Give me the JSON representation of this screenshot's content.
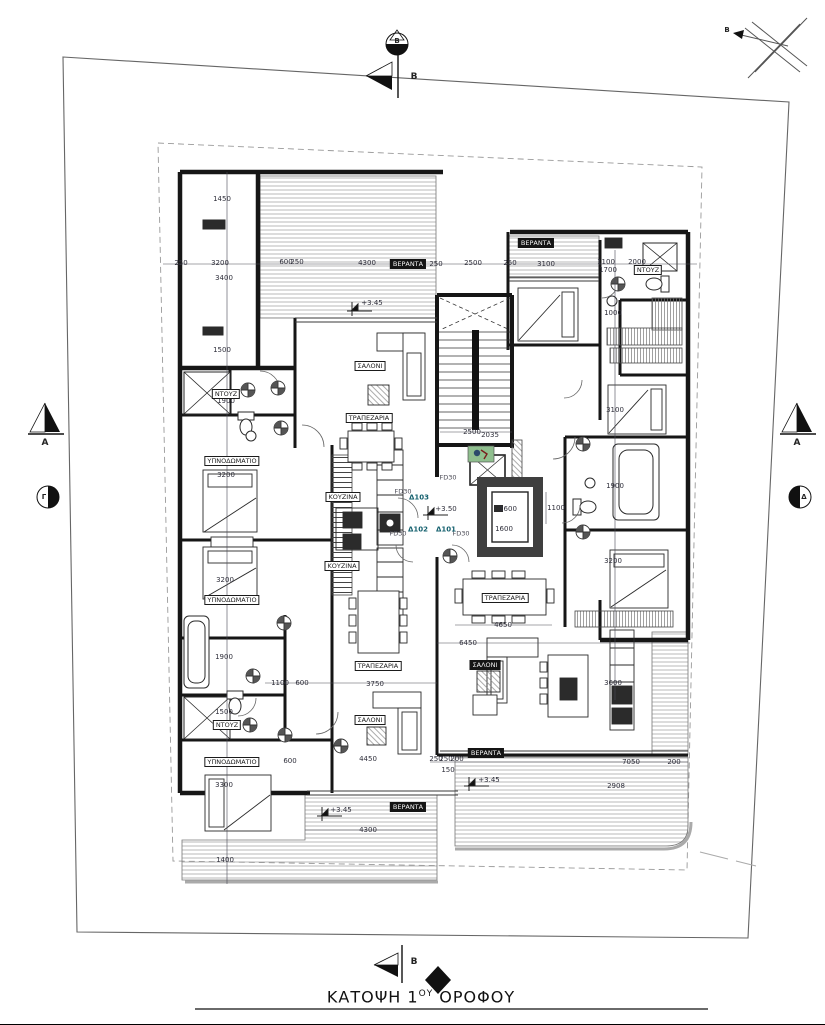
{
  "title": {
    "prefix": "ΚΑΤΟΨΗ 1",
    "sup": "ΟΥ",
    "rest": " ΟΡΟΦΟΥ"
  },
  "north": {
    "label": "Β"
  },
  "section_markers": {
    "top_b": "B",
    "bottom_b": "B",
    "left_a": "A",
    "right_a": "A",
    "circle_top": "Β",
    "circle_left": "Γ",
    "circle_right": "Δ"
  },
  "colors": {
    "ink": "#1b1b1b",
    "dim_text": "#2e2e3a",
    "door_label": "#14606e",
    "accent_green": "#8fbf8e"
  },
  "room_labels": [
    {
      "text": "ΒΕΡΑΝΤΑ",
      "x": 408,
      "y": 264,
      "cls": "dark"
    },
    {
      "text": "ΒΕΡΑΝΤΑ",
      "x": 536,
      "y": 243,
      "cls": "dark"
    },
    {
      "text": "ΒΕΡΑΝΤΑ",
      "x": 486,
      "y": 753,
      "cls": "dark"
    },
    {
      "text": "ΒΕΡΑΝΤΑ",
      "x": 408,
      "y": 807,
      "cls": "dark"
    },
    {
      "text": "ΣΑΛΟΝΙ",
      "x": 485,
      "y": 665,
      "cls": "dark"
    },
    {
      "text": "ΣΑΛΟΝΙ",
      "x": 370,
      "y": 366,
      "cls": ""
    },
    {
      "text": "ΣΑΛΟΝΙ",
      "x": 370,
      "y": 720,
      "cls": ""
    },
    {
      "text": "ΤΡΑΠΕΖΑΡΙΑ",
      "x": 369,
      "y": 418,
      "cls": ""
    },
    {
      "text": "ΤΡΑΠΕΖΑΡΙΑ",
      "x": 378,
      "y": 666,
      "cls": ""
    },
    {
      "text": "ΤΡΑΠΕΖΑΡΙΑ",
      "x": 505,
      "y": 598,
      "cls": ""
    },
    {
      "text": "ΚΟΥΖΙΝΑ",
      "x": 343,
      "y": 497,
      "cls": ""
    },
    {
      "text": "ΚΟΥΖΙΝΑ",
      "x": 342,
      "y": 566,
      "cls": ""
    },
    {
      "text": "ΥΠΝΟΔΩΜΑΤΙΟ",
      "x": 232,
      "y": 461,
      "cls": ""
    },
    {
      "text": "ΥΠΝΟΔΩΜΑΤΙΟ",
      "x": 232,
      "y": 600,
      "cls": ""
    },
    {
      "text": "ΥΠΝΟΔΩΜΑΤΙΟ",
      "x": 232,
      "y": 762,
      "cls": ""
    },
    {
      "text": "ΝΤΟΥΖ",
      "x": 226,
      "y": 394,
      "cls": ""
    },
    {
      "text": "ΝΤΟΥΖ",
      "x": 227,
      "y": 725,
      "cls": ""
    },
    {
      "text": "ΝΤΟΥΖ",
      "x": 648,
      "y": 270,
      "cls": ""
    }
  ],
  "dimensions": [
    {
      "text": "250",
      "x": 181,
      "y": 263
    },
    {
      "text": "3200",
      "x": 220,
      "y": 263
    },
    {
      "text": "600",
      "x": 286,
      "y": 262
    },
    {
      "text": "250",
      "x": 297,
      "y": 262
    },
    {
      "text": "4300",
      "x": 367,
      "y": 263
    },
    {
      "text": "250",
      "x": 436,
      "y": 264
    },
    {
      "text": "2500",
      "x": 473,
      "y": 263
    },
    {
      "text": "250",
      "x": 510,
      "y": 263
    },
    {
      "text": "3100",
      "x": 546,
      "y": 264
    },
    {
      "text": "1100",
      "x": 606,
      "y": 262
    },
    {
      "text": "1700",
      "x": 608,
      "y": 270
    },
    {
      "text": "2000",
      "x": 637,
      "y": 262
    },
    {
      "text": "1000",
      "x": 613,
      "y": 313
    },
    {
      "text": "1450",
      "x": 222,
      "y": 199
    },
    {
      "text": "3400",
      "x": 224,
      "y": 278
    },
    {
      "text": "1500",
      "x": 222,
      "y": 350
    },
    {
      "text": "1900",
      "x": 226,
      "y": 401
    },
    {
      "text": "3200",
      "x": 226,
      "y": 475
    },
    {
      "text": "3200",
      "x": 225,
      "y": 580
    },
    {
      "text": "1900",
      "x": 224,
      "y": 657
    },
    {
      "text": "1500",
      "x": 224,
      "y": 712
    },
    {
      "text": "3300",
      "x": 224,
      "y": 785
    },
    {
      "text": "1400",
      "x": 225,
      "y": 860
    },
    {
      "text": "2500",
      "x": 472,
      "y": 432
    },
    {
      "text": "2035",
      "x": 490,
      "y": 435
    },
    {
      "text": "1600",
      "x": 508,
      "y": 509
    },
    {
      "text": "1600",
      "x": 504,
      "y": 529
    },
    {
      "text": "1100",
      "x": 556,
      "y": 508
    },
    {
      "text": "3100",
      "x": 615,
      "y": 410
    },
    {
      "text": "1900",
      "x": 615,
      "y": 486
    },
    {
      "text": "3200",
      "x": 613,
      "y": 561
    },
    {
      "text": "3600",
      "x": 613,
      "y": 683
    },
    {
      "text": "1100",
      "x": 280,
      "y": 683
    },
    {
      "text": "600",
      "x": 302,
      "y": 683
    },
    {
      "text": "3750",
      "x": 375,
      "y": 684
    },
    {
      "text": "4650",
      "x": 503,
      "y": 625
    },
    {
      "text": "6450",
      "x": 468,
      "y": 643
    },
    {
      "text": "4450",
      "x": 368,
      "y": 759
    },
    {
      "text": "600",
      "x": 290,
      "y": 761
    },
    {
      "text": "4300",
      "x": 368,
      "y": 830
    },
    {
      "text": "7050",
      "x": 631,
      "y": 762
    },
    {
      "text": "200",
      "x": 674,
      "y": 762
    },
    {
      "text": "2908",
      "x": 616,
      "y": 786
    },
    {
      "text": "250",
      "x": 436,
      "y": 759
    },
    {
      "text": "250",
      "x": 446,
      "y": 759
    },
    {
      "text": "200",
      "x": 457,
      "y": 759
    },
    {
      "text": "150",
      "x": 448,
      "y": 770
    }
  ],
  "annotations": [
    {
      "text": "FD30",
      "x": 448,
      "y": 478,
      "cls": ""
    },
    {
      "text": "FD30",
      "x": 403,
      "y": 492,
      "cls": ""
    },
    {
      "text": "FD30",
      "x": 398,
      "y": 534,
      "cls": ""
    },
    {
      "text": "FD30",
      "x": 461,
      "y": 534,
      "cls": ""
    },
    {
      "text": "Δ103",
      "x": 419,
      "y": 498,
      "cls": "apt"
    },
    {
      "text": "Δ102",
      "x": 418,
      "y": 530,
      "cls": "apt"
    },
    {
      "text": "Δ101",
      "x": 446,
      "y": 530,
      "cls": "apt"
    }
  ],
  "level_markers": [
    {
      "text": "+3.45",
      "x": 372,
      "y": 303
    },
    {
      "text": "+3.50",
      "x": 446,
      "y": 509
    },
    {
      "text": "+3.45",
      "x": 341,
      "y": 810
    },
    {
      "text": "+3.45",
      "x": 489,
      "y": 780
    }
  ]
}
